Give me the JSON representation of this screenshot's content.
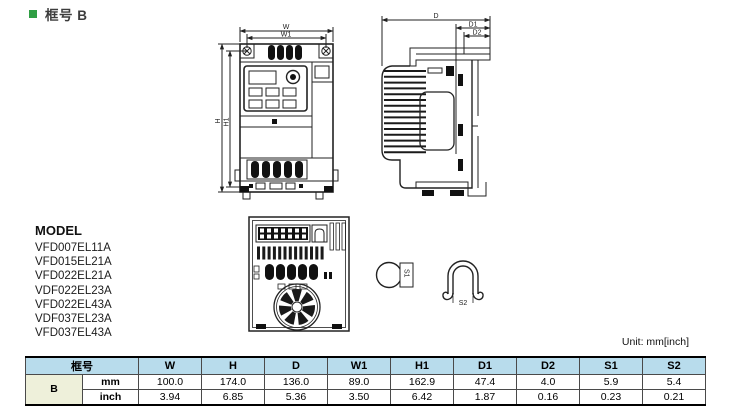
{
  "section": {
    "title": "框号 B"
  },
  "drawings": {
    "front_view": {
      "w": "W",
      "w1": "W1",
      "h": "H",
      "h1": "H1"
    },
    "side_view": {
      "d": "D",
      "d1": "D1",
      "d2": "D2"
    },
    "s1": "S1",
    "s2": "S2"
  },
  "model_list": {
    "heading": "MODEL",
    "items": [
      "VFD007EL11A",
      "VFD015EL21A",
      "VFD022EL21A",
      "VDF022EL23A",
      "VFD022EL43A",
      "VDF037EL23A",
      "VFD037EL43A"
    ]
  },
  "unit_note": "Unit: mm[inch]",
  "table": {
    "frame_col_header": "框号",
    "dim_headers": [
      "W",
      "H",
      "D",
      "W1",
      "H1",
      "D1",
      "D2",
      "S1",
      "S2"
    ],
    "frame_name": "B",
    "rows": [
      {
        "unit": "mm",
        "values": [
          "100.0",
          "174.0",
          "136.0",
          "89.0",
          "162.9",
          "47.4",
          "4.0",
          "5.9",
          "5.4"
        ]
      },
      {
        "unit": "inch",
        "values": [
          "3.94",
          "6.85",
          "5.36",
          "3.50",
          "6.42",
          "1.87",
          "0.16",
          "0.23",
          "0.21"
        ]
      }
    ]
  },
  "colors": {
    "accent_green": "#2f9e44",
    "table_header_bg": "#b8dcec",
    "frame_cell_bg": "#eef0da",
    "line_color": "#222222"
  }
}
